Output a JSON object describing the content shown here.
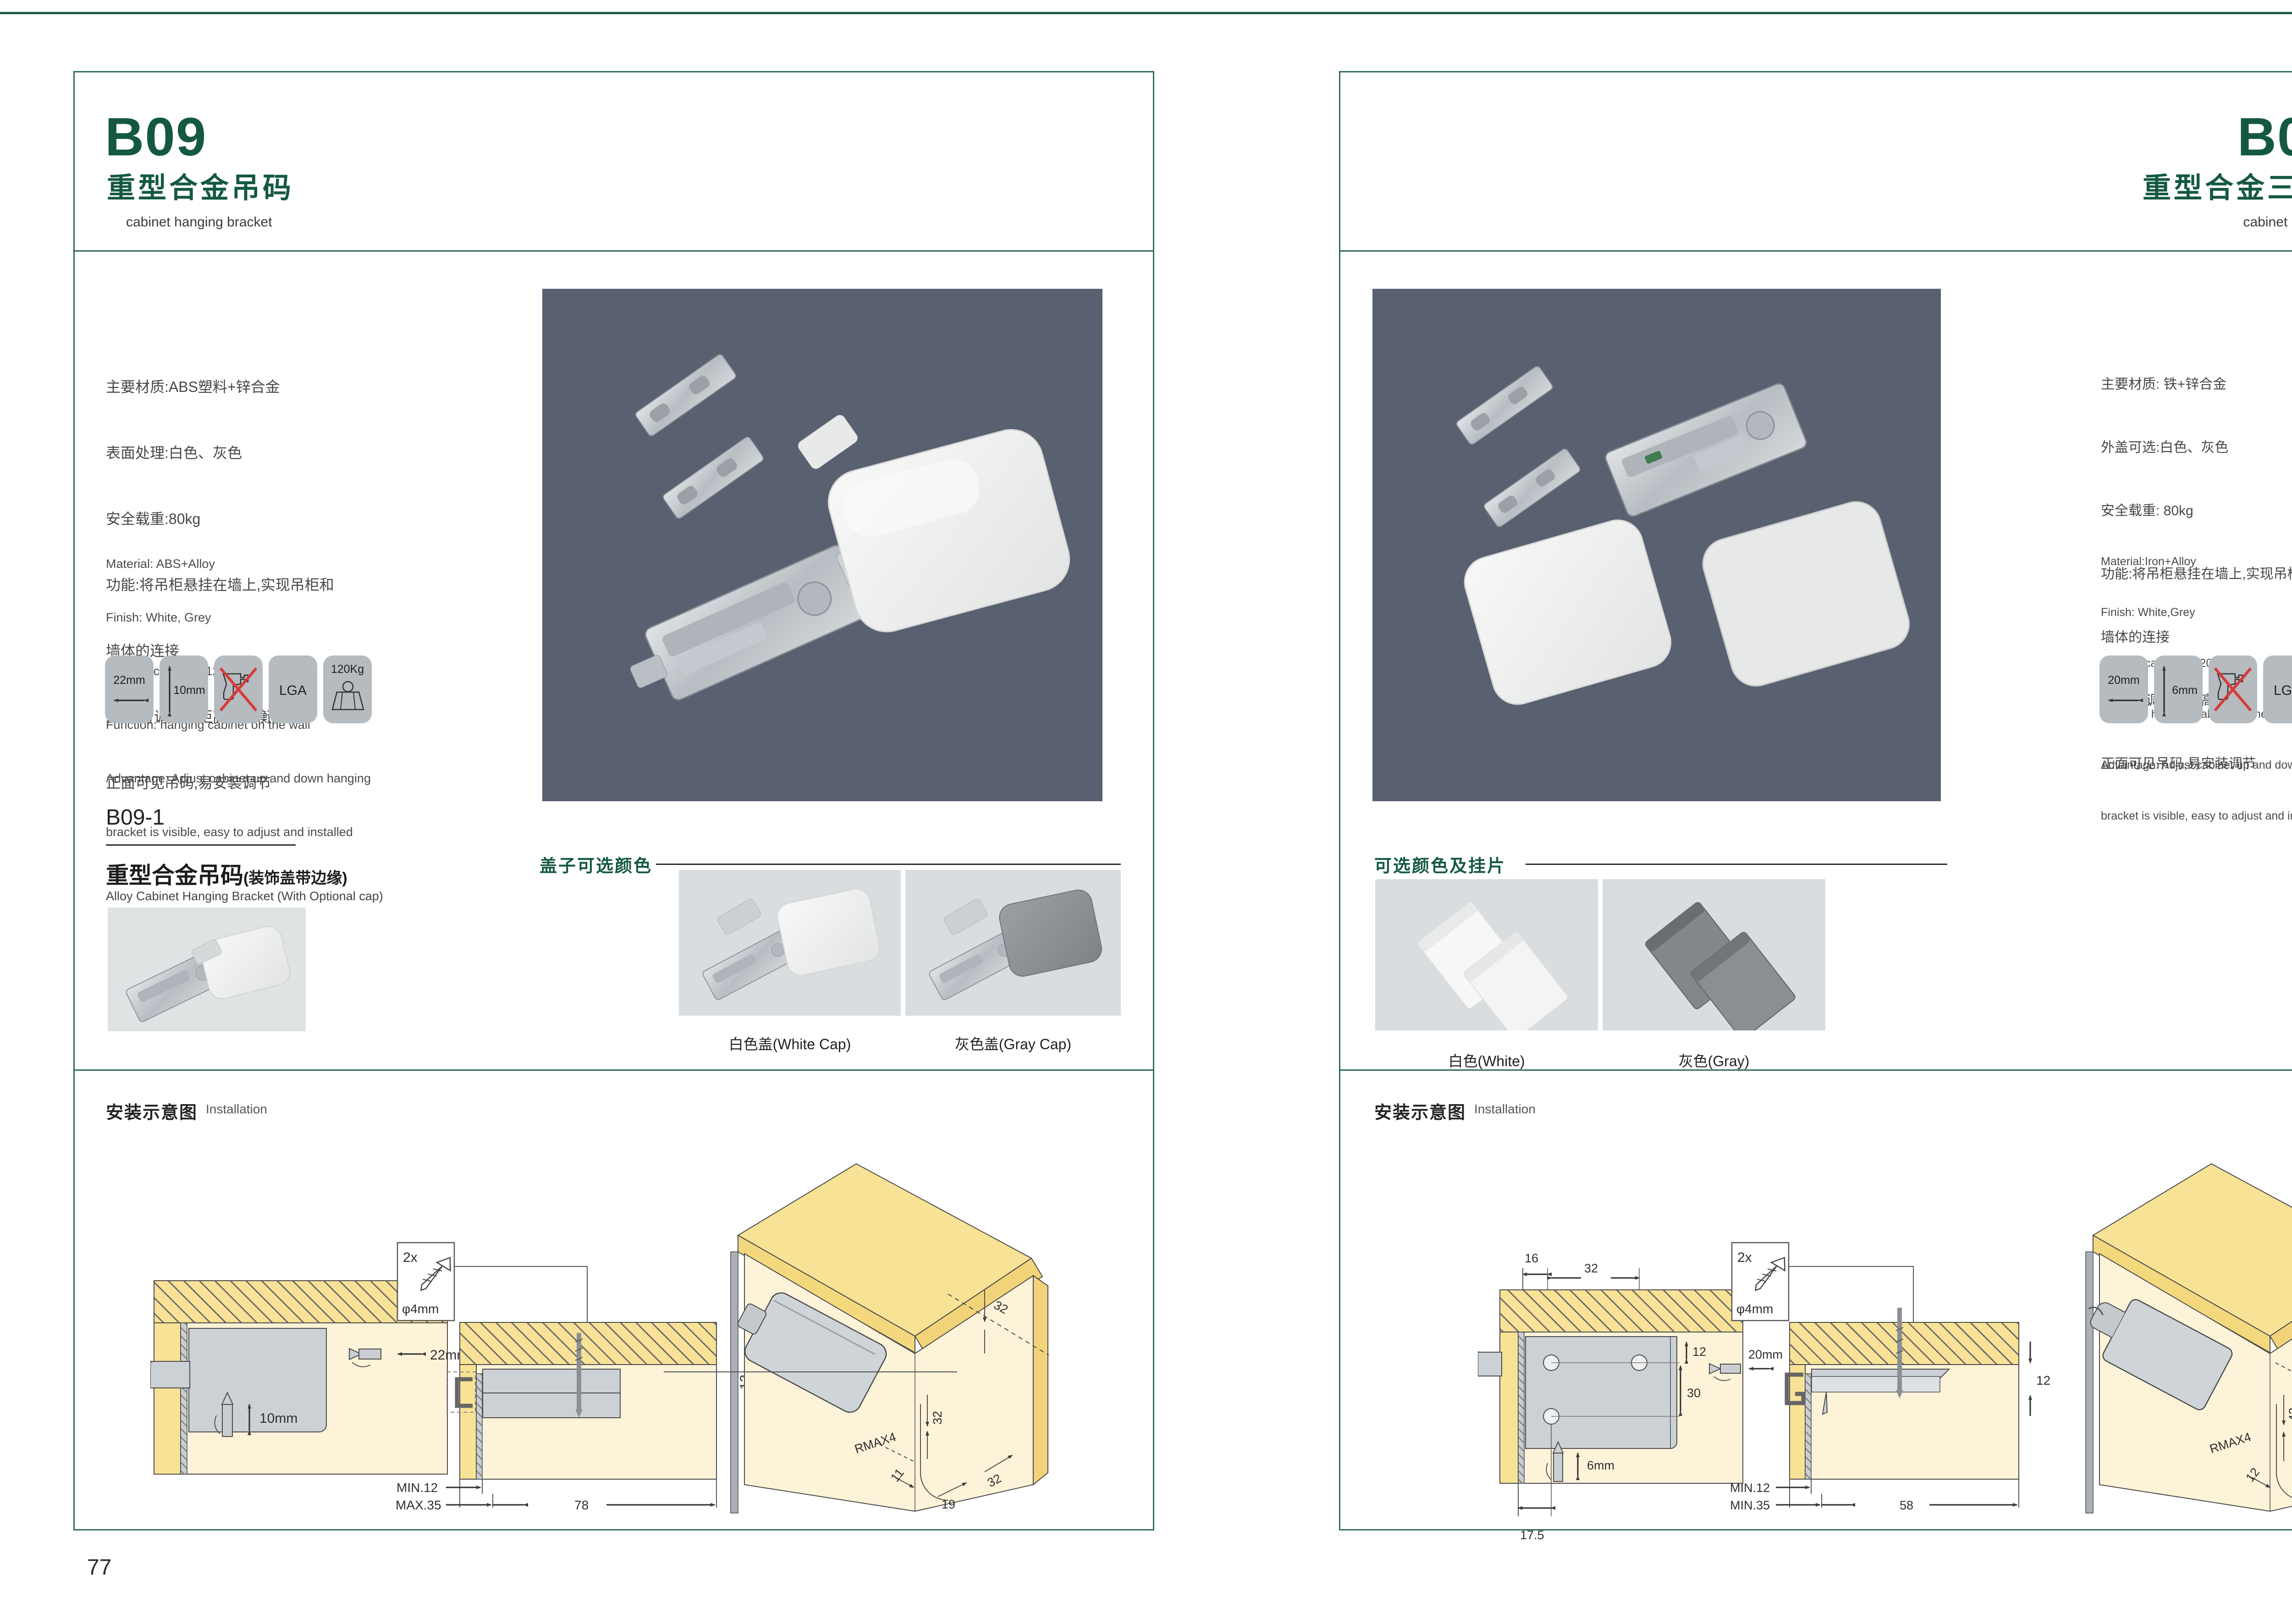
{
  "left_page": {
    "code": "B09",
    "title_cn": "重型合金吊码",
    "title_en": "cabinet hanging bracket",
    "specs_cn": [
      "主要材质:ABS塑料+锌合金",
      "表面处理:白色、灰色",
      "安全载重:80kg",
      "功能:将吊柜悬挂在墙上,实现吊柜和",
      "墙体的连接",
      "优点:可调节吊柜高低平衡",
      "正面可见吊码,易安装调节"
    ],
    "specs_en": [
      "Material: ABS+Alloy",
      "Finish: White, Grey",
      "Loading capacity: 120kg",
      "Function: hanging cabinet on the wall",
      "Advantage: Adjust cabinet up and down hanging",
      "bracket is visible, easy to adjust and installed"
    ],
    "badges": {
      "b1": "22mm",
      "b2": "10mm",
      "b4": "LGA",
      "b5": "120Kg"
    },
    "sub": {
      "code": "B09-1",
      "title_cn": "重型合金吊码",
      "title_suffix": "(装饰盖带边缘)",
      "title_en": "Alloy Cabinet Hanging Bracket (With Optional cap)"
    },
    "caps": {
      "heading": "盖子可选颜色",
      "white_label": "白色盖(White Cap)",
      "gray_label": "灰色盖(Gray Cap)"
    },
    "install": {
      "heading_cn": "安装示意图",
      "heading_en": "Installation",
      "d1": {
        "dim1": "22mm",
        "dim2": "10mm"
      },
      "d2": {
        "screw_count": "2x",
        "screw_dia": "φ4mm",
        "dim1": "13",
        "dim2": "MIN.12",
        "dim3": "MAX.35",
        "dim4": "78"
      },
      "d3": {
        "dim1": "32",
        "dim2": "32",
        "dim3": "RMAX4",
        "dim4": "11",
        "dim5": "19",
        "dim6": "32"
      }
    },
    "page_number": "77"
  },
  "right_page": {
    "code": "B09-3",
    "title_cn": "重型合金三孔吊码",
    "title_en": "cabinet hanging bracket",
    "specs_cn": [
      "主要材质: 铁+锌合金",
      "外盖可选:白色、灰色",
      "安全载重: 80kg",
      "功能:将吊柜悬挂在墙上,实现吊柜和",
      "墙体的连接",
      "优点:可调节吊柜高低平衡",
      "正面可见吊码,易安装调节"
    ],
    "specs_en": [
      "Material:Iron+Alloy",
      "Finish: White,Grey",
      "Loading capacity: 120kg",
      "Function: hanging cabinet on the wall",
      "Advantage: Adjust cabinet up and down hanging",
      "bracket is visible, easy to adjust and installed"
    ],
    "badges": {
      "b1": "20mm",
      "b2": "6mm",
      "b4": "LGA",
      "b5": "120Kg"
    },
    "caps": {
      "heading": "可选颜色及挂片",
      "white_label": "白色(White)",
      "gray_label": "灰色(Gray)"
    },
    "install": {
      "heading_cn": "安装示意图",
      "heading_en": "Installation",
      "d1": {
        "dim1": "16",
        "dim2": "32",
        "dim3": "12",
        "dim4": "30",
        "dim5": "20mm",
        "dim6": "6mm",
        "dim7": "17.5"
      },
      "d2": {
        "screw_count": "2x",
        "screw_dia": "φ4mm",
        "dim1": "12",
        "dim2": "MIN.12",
        "dim3": "MIN.35",
        "dim4": "58"
      },
      "d3": {
        "dim1": "12",
        "dim2": "16",
        "dim3": "42",
        "dim4": "RMAX4",
        "dim5": "12",
        "dim6": "17.5",
        "dim7": "32"
      }
    },
    "page_number": "78"
  }
}
